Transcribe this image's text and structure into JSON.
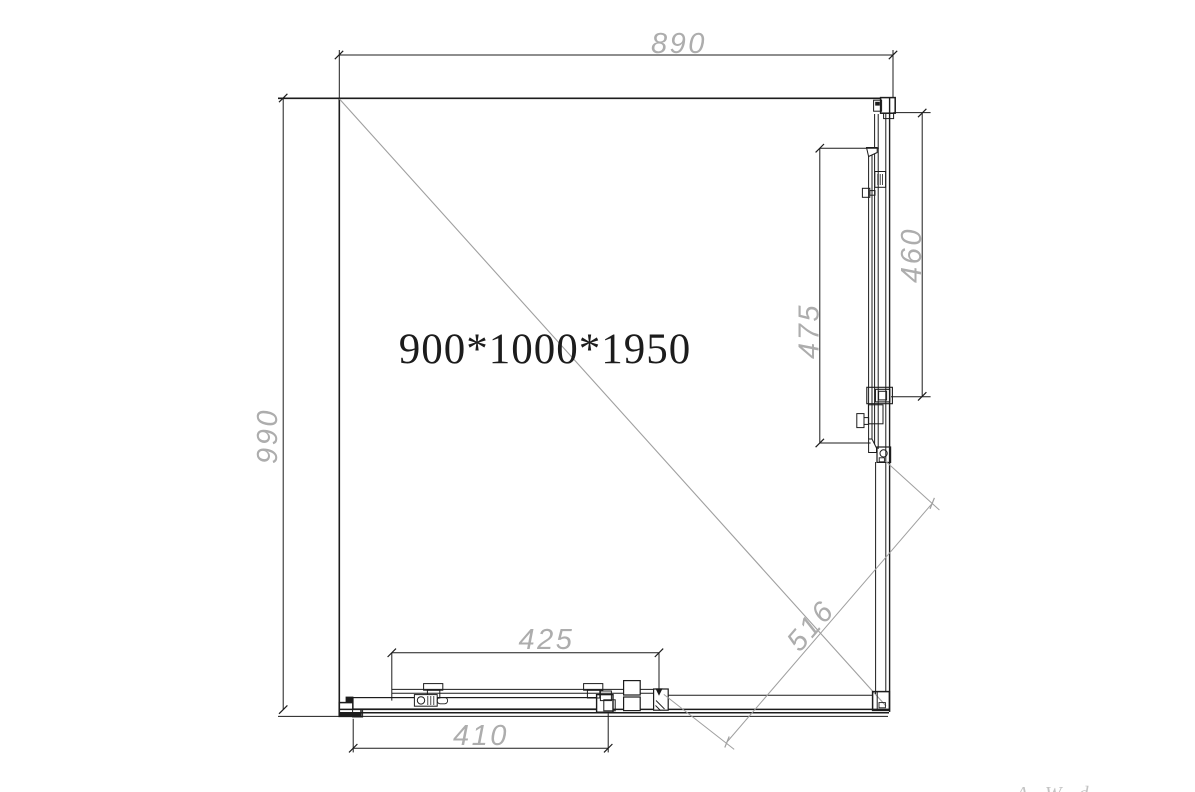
{
  "drawing": {
    "size_label": "900*1000*1950",
    "dims": {
      "top_width": "890",
      "left_depth": "990",
      "right_outer": "460",
      "right_inner": "475",
      "bottom_upper": "425",
      "bottom_lower": "410",
      "diagonal": "516"
    },
    "watermark": "A W d"
  },
  "colors": {
    "line": "#1c1c1c",
    "dim_text": "#adadad",
    "gray_line": "#9f9f9f",
    "background": "#ffffff"
  }
}
